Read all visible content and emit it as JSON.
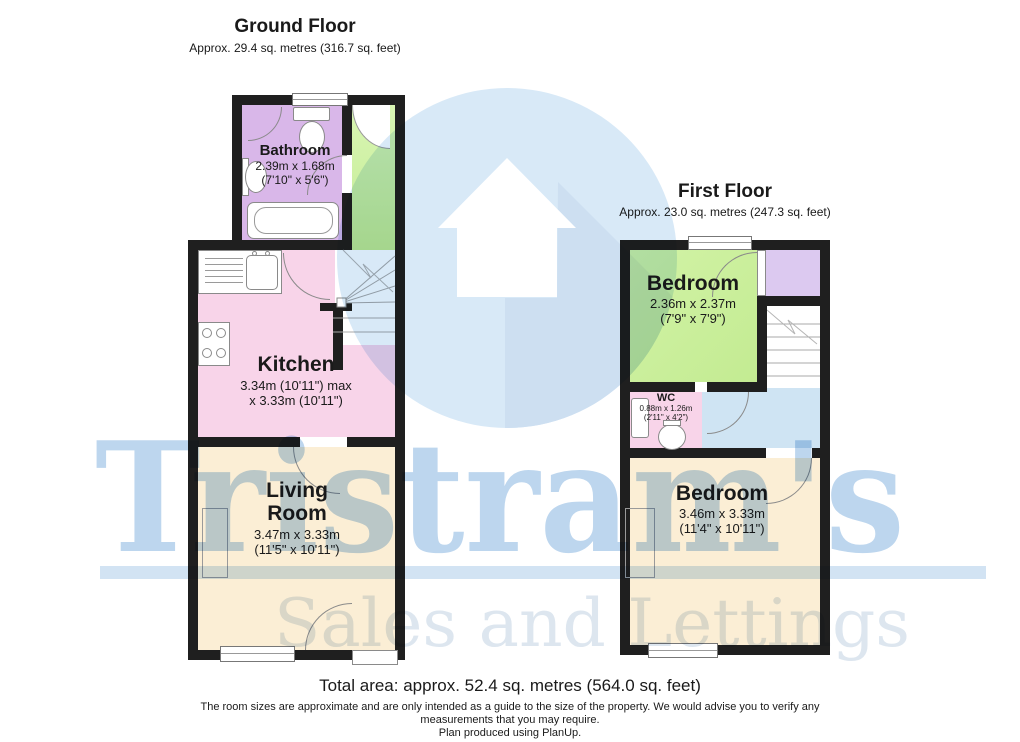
{
  "brand": {
    "name": "Tristram's",
    "tagline": "Sales and Lettings"
  },
  "ground_floor": {
    "title": "Ground Floor",
    "area": "Approx. 29.4 sq. metres (316.7 sq. feet)",
    "rooms": {
      "bathroom": {
        "name": "Bathroom",
        "dim_m": "2.39m x 1.68m",
        "dim_ft": "(7'10\" x 5'6\")"
      },
      "kitchen": {
        "name": "Kitchen",
        "dim_m": "3.34m (10'11\") max",
        "dim_ft": "x 3.33m (10'11\")"
      },
      "living_room": {
        "name": "Living Room",
        "dim_m": "3.47m x 3.33m",
        "dim_ft": "(11'5\" x 10'11\")"
      }
    }
  },
  "first_floor": {
    "title": "First Floor",
    "area": "Approx. 23.0 sq. metres (247.3 sq. feet)",
    "rooms": {
      "bedroom_front": {
        "name": "Bedroom",
        "dim_m": "2.36m x 2.37m",
        "dim_ft": "(7'9\" x 7'9\")"
      },
      "wc": {
        "name": "WC",
        "dim_m": "0.88m x 1.26m",
        "dim_ft": "(2'11\" x 4'2\")"
      },
      "bedroom_back": {
        "name": "Bedroom",
        "dim_m": "3.46m x 3.33m",
        "dim_ft": "(11'4\" x 10'11\")"
      }
    }
  },
  "footer": {
    "total_area": "Total area: approx. 52.4 sq. metres (564.0 sq. feet)",
    "disclaimer_1": "The room sizes are approximate and are only intended as a guide to the size of the property. We would advise you to verify any",
    "disclaimer_2": "measurements that you may require.",
    "disclaimer_3": "Plan produced using PlanUp."
  },
  "colors": {
    "wall": "#1f1f1f",
    "bathroom": "#d9b7e9",
    "hall": "#c9ef9e",
    "kitchen": "#f8d4e9",
    "living_room": "#fbeed5",
    "bedroom_front": "#c9ef9e",
    "closet": "#dcc9f0",
    "landing": "#cfe4f3",
    "wc": "#f8d4e9",
    "bedroom_back": "#fbeed5",
    "brand_blue": "#bdd6ee",
    "logo_circle": "#d8e9f7",
    "tagline_gray": "#dde6ef"
  }
}
